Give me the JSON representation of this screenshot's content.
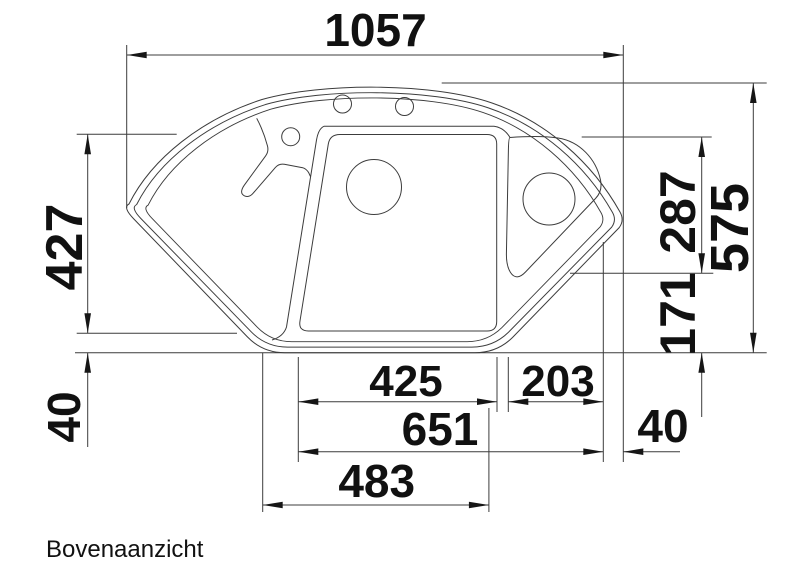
{
  "title": "Bovenaanzicht",
  "drawing": {
    "type": "technical-top-view",
    "object": "corner sink with main bowl, corner bowl, drainer wing, tap console and two tap holes",
    "dimensions": {
      "overall_width": "1057",
      "overall_depth": "575",
      "bowl_zone_depth": "427",
      "rim_width_left": "40",
      "corner_bowl_depth": "287",
      "lower_right_depth": "171",
      "main_bowl_width": "425",
      "corner_bowl_width": "203",
      "bowls_combined_width": "651",
      "bottom_edge_width": "483",
      "rim_width_right": "40"
    }
  }
}
